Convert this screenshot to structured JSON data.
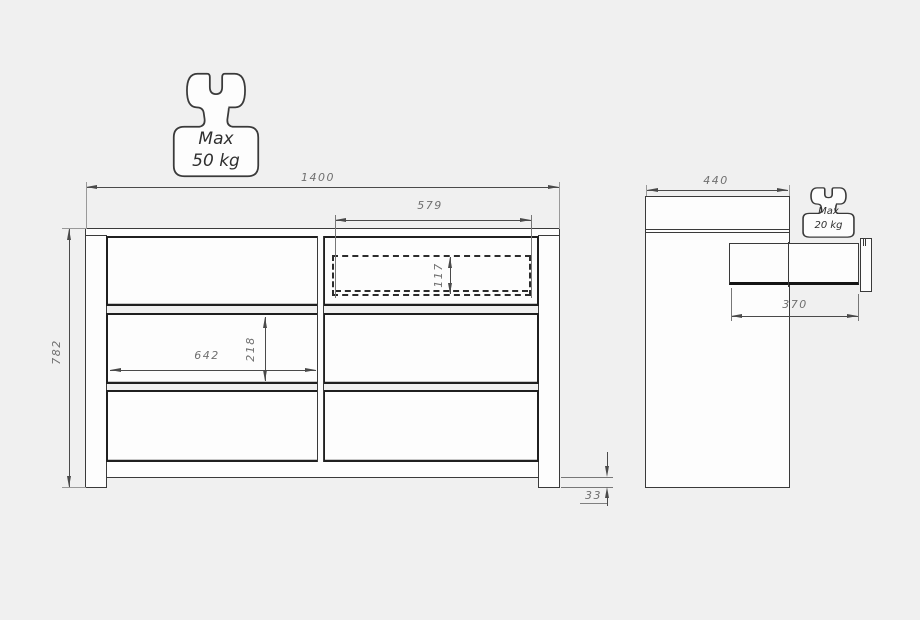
{
  "colors": {
    "background": "#f0f0f0",
    "surface": "#fdfdfd",
    "line": "#3a3a3a",
    "line_strong": "#1f1f1f",
    "line_soft": "#999999",
    "dim_line": "#4a4a4a",
    "dim_text": "#6f6f6f"
  },
  "front_view": {
    "overall_width_mm": "1400",
    "overall_height_mm": "782",
    "internal_drawer_width_mm": "579",
    "internal_drawer_height_mm": "117",
    "drawer_opening_width_mm": "642",
    "drawer_front_height_mm": "218",
    "plinth_height_mm": "33",
    "weight_limit": {
      "line1": "Max",
      "line2": "50 kg"
    }
  },
  "side_view": {
    "depth_mm": "440",
    "drawer_extension_mm": "370",
    "drawer_weight_limit": {
      "line1": "Max",
      "line2": "20 kg"
    }
  }
}
